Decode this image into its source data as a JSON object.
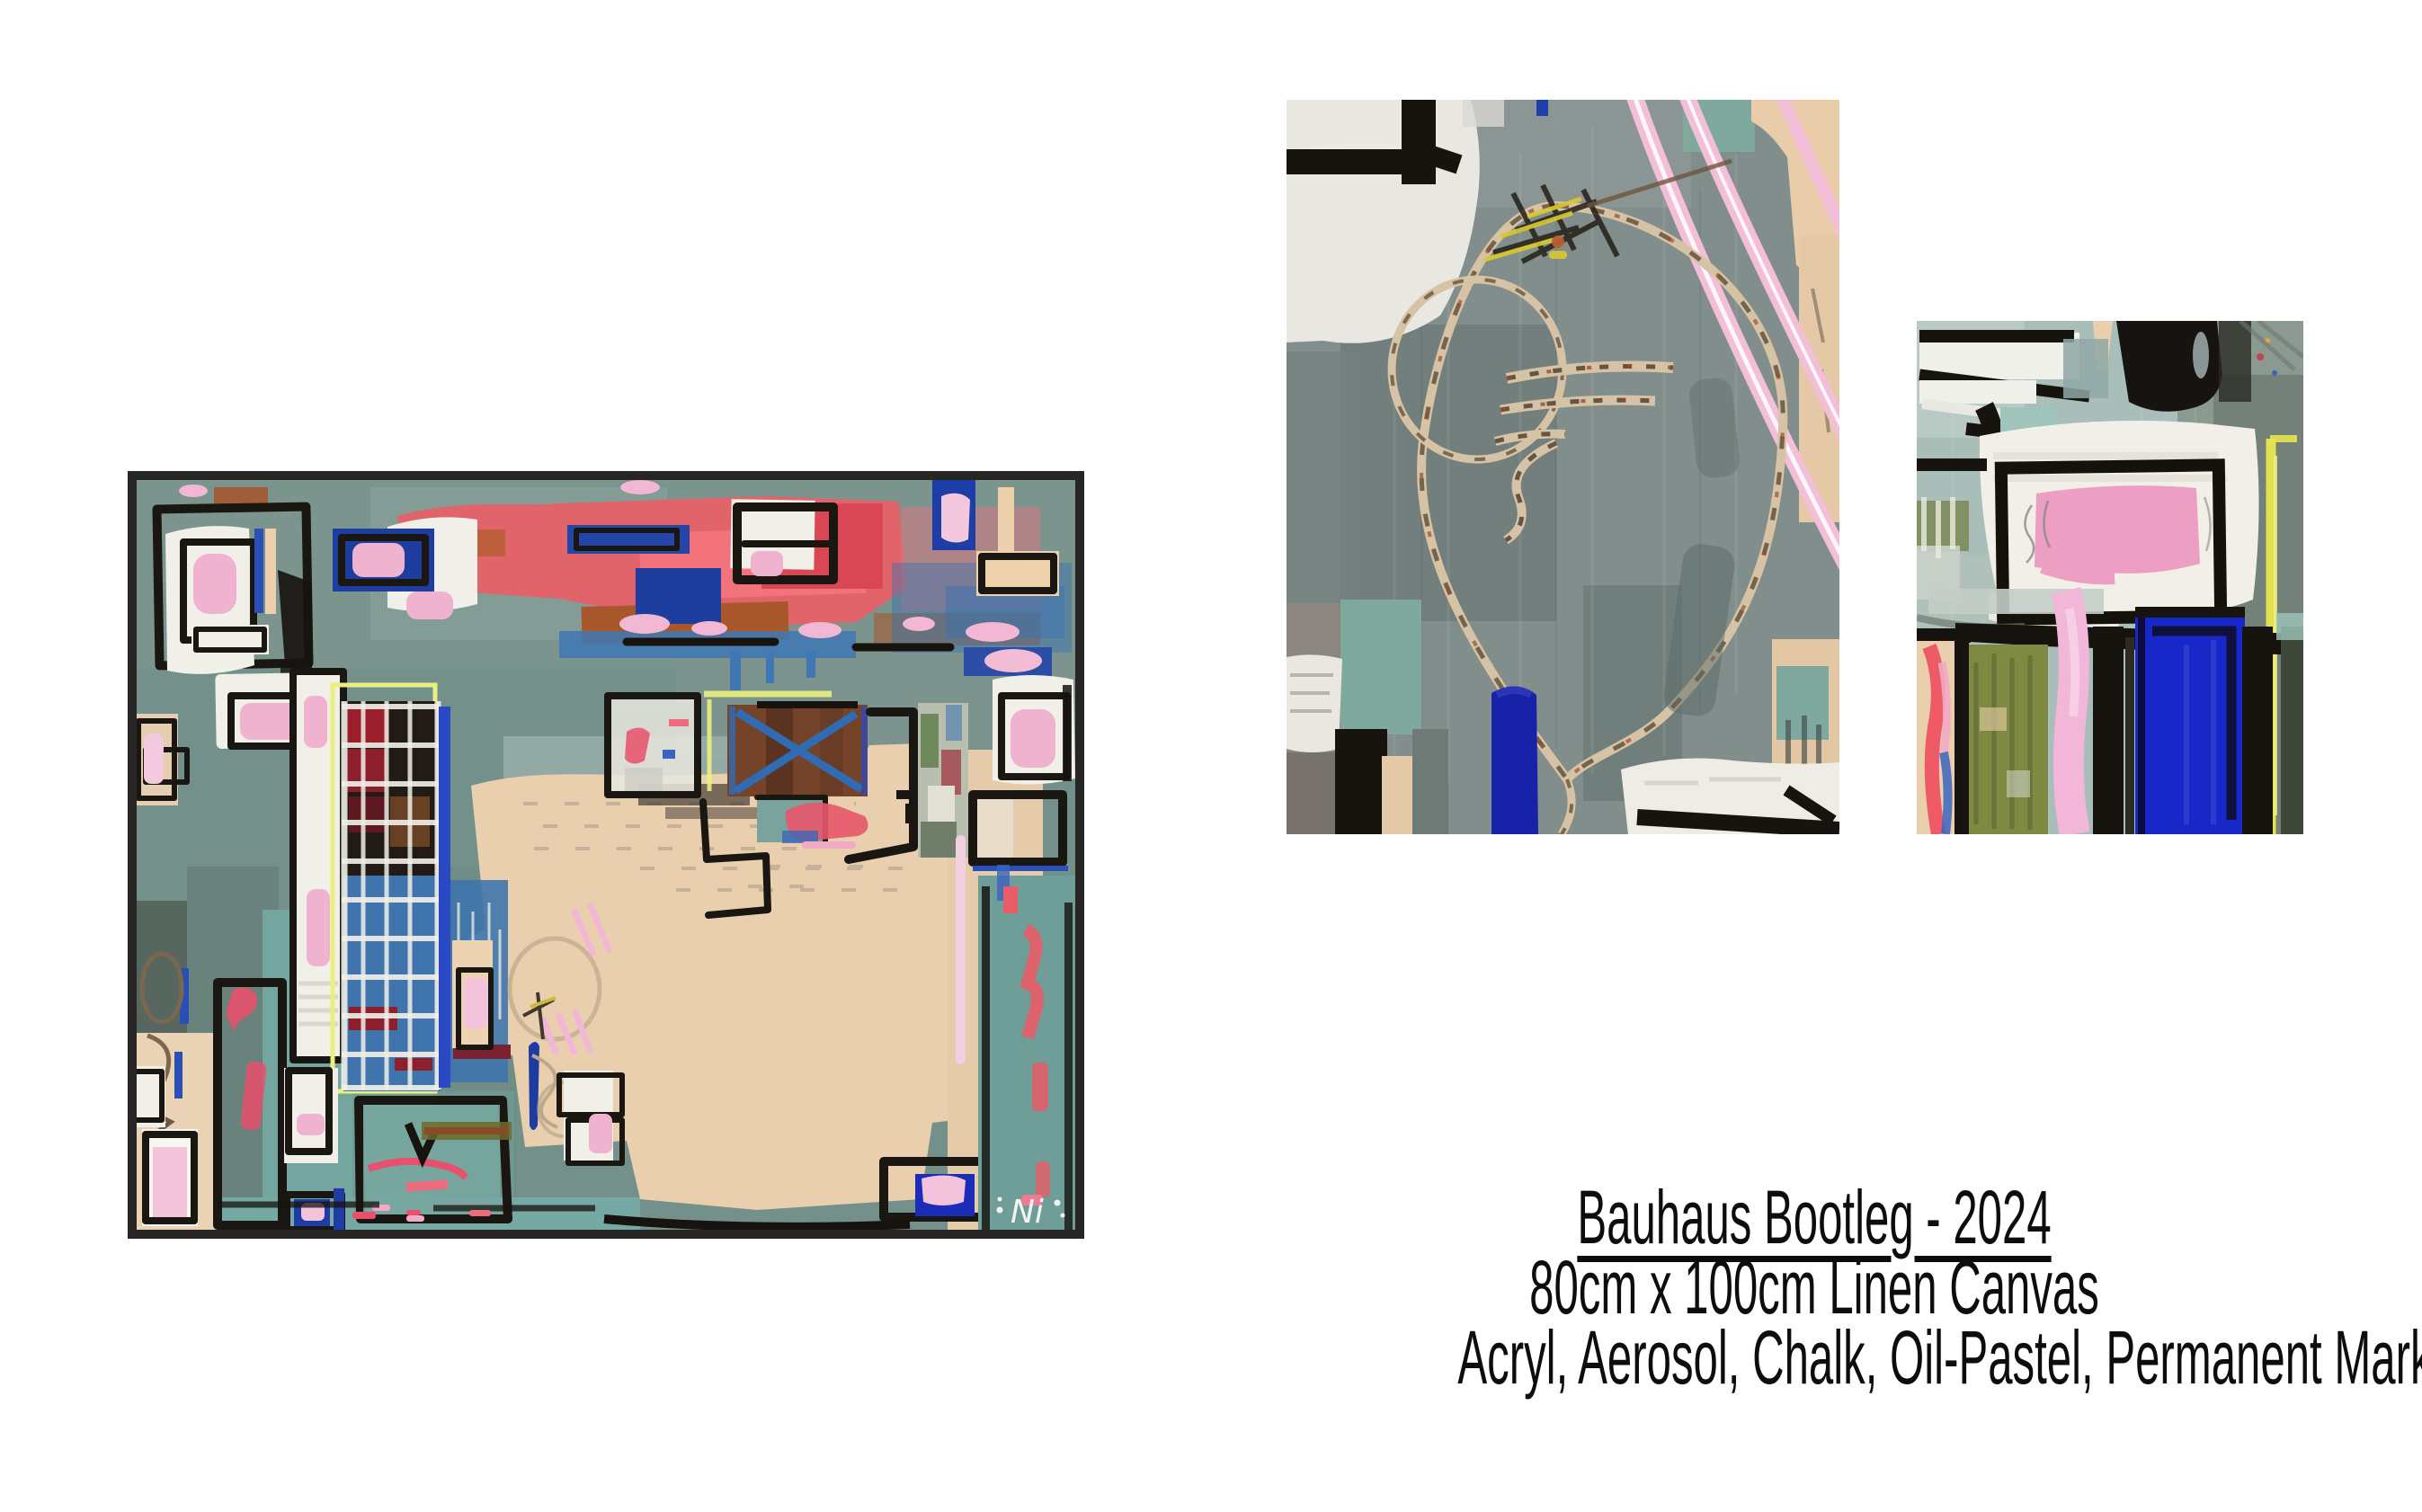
{
  "page": {
    "background_color": "#ffffff"
  },
  "caption": {
    "title": "Bauhaus Bootleg - 2024",
    "dimensions": "80cm x 100cm Linen Canvas",
    "media": "Acryl, Aerosol, Chalk, Oil-Pastel, Permanent Marker",
    "text_color": "#0d0d0d"
  },
  "artwork": {
    "signature": "Ni",
    "frame_color": "#282624",
    "palette": {
      "teal_background": "#74908a",
      "bright_teal": "#76a9a3",
      "beige": "#e9cfad",
      "coral_red": "#e95f67",
      "crimson": "#9a1f2b",
      "pink": "#f0b3cf",
      "royal_blue": "#1d3e9f",
      "steel_blue": "#3f74ad",
      "chalk_yellow": "#e9f07e",
      "black": "#1a1611",
      "white": "#f0efe8",
      "detail_gray": "#818e8b"
    }
  },
  "images": {
    "main_label": "full painting, framed",
    "detail_center_label": "detail crop, circular sgraffito drawing",
    "detail_right_label": "detail crop, pink rectangle and blue block"
  }
}
